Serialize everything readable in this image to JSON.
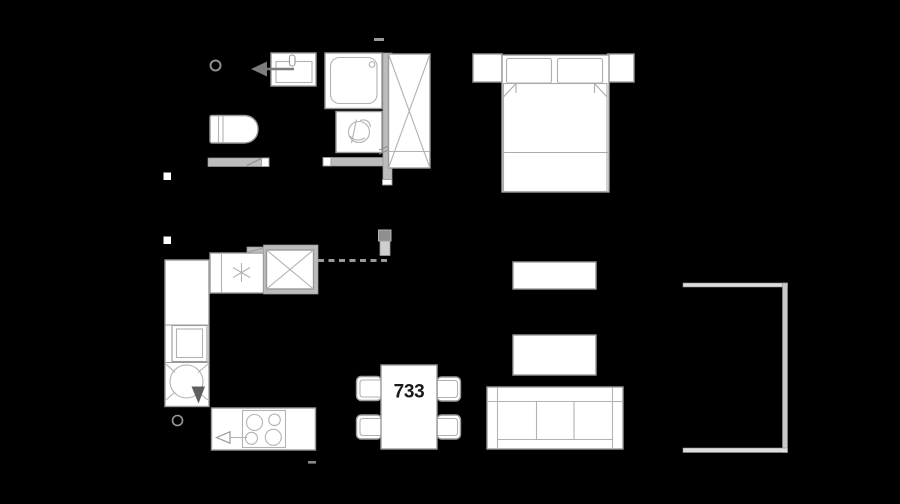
{
  "canvas": {
    "width": 900,
    "height": 504
  },
  "colors": {
    "background": "#000000",
    "furniture_fill": "#ffffff",
    "outline_strong": "#9a9a9a",
    "outline_light": "#b2b2b2",
    "wall_gray": "#bcbcbc",
    "accent_dark": "#5f5f5f",
    "arrow_gray": "#7d7d7d",
    "label_text": "#1a1a1a"
  },
  "dining_table": {
    "label": "733"
  },
  "furniture_legend": {
    "bathroom": [
      "door-stop",
      "washbasin",
      "entry-arrow",
      "toilet",
      "shower",
      "washing-machine",
      "partition-wall",
      "door-opening-walls"
    ],
    "bedroom": [
      "nightstand-left",
      "double-bed",
      "pillows",
      "blanket",
      "nightstand-right",
      "wardrobe"
    ],
    "kitchen": [
      "fridge-with-snowflake",
      "tall-cabinet-x",
      "counter-left",
      "oven",
      "boiler-circle",
      "sink-arrow-triangle",
      "cooktop-counter",
      "four-burner-hob",
      "extractor-triangle"
    ],
    "dining": [
      "dining-table",
      "chair",
      "chair",
      "chair",
      "chair"
    ],
    "living": [
      "sideboard",
      "coffee-table",
      "sofa-three-seat"
    ],
    "balcony": [
      "balcony-outline"
    ]
  }
}
